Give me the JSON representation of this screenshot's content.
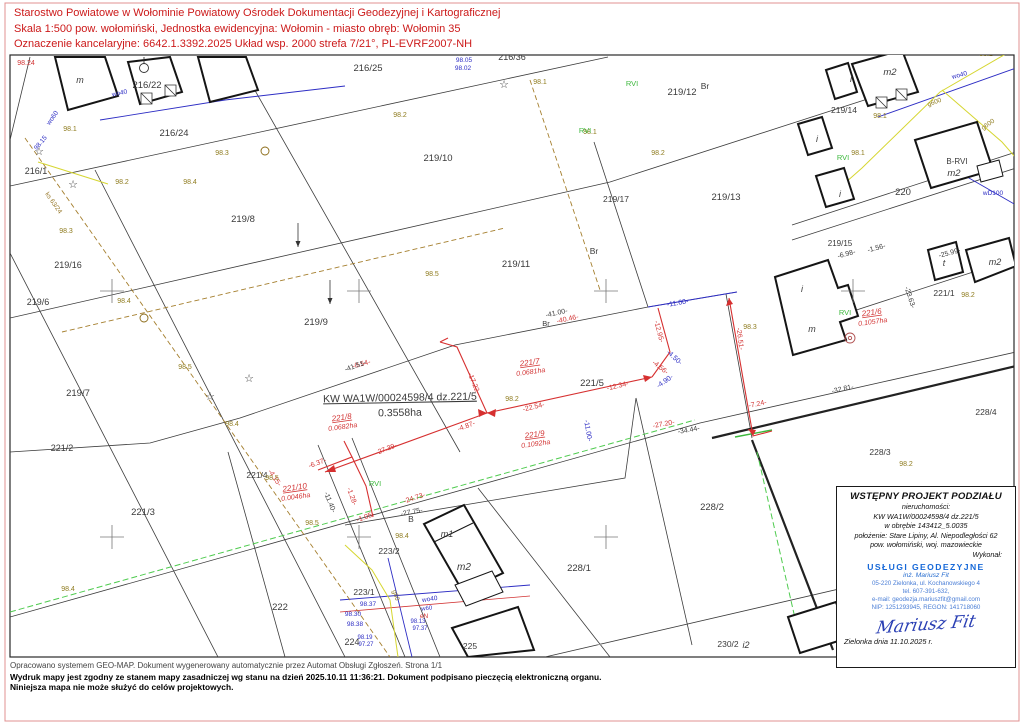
{
  "colors": {
    "k": "#3a3a3a",
    "r": "#d23333",
    "o": "#8f7c1f",
    "b": "#2d2dc4",
    "g": "#3cb83c",
    "n": "#9a7b2e"
  },
  "header": {
    "lines": [
      "Starostwo Powiatowe w Wołominie Powiatowy Ośrodek Dokumentacji Geodezyjnej i Kartograficznej",
      "Skala 1:500  pow. wołomiński, Jednostka ewidencyjna: Wołomin - miasto obręb: Wołomin 35",
      "Oznaczenie kancelaryjne: 6642.1.3392.2025  Układ wsp. 2000 strefa 7/21°, PL-EVRF2007-NH"
    ]
  },
  "footer": {
    "lines": [
      "Opracowano systemem GEO-MAP. Dokument wygenerowany automatycznie przez Automat Obsługi Zgłoszeń. Strona 1/1",
      "Wydruk mapy jest zgodny ze stanem mapy zasadniczej wg stanu na dzień 2025.10.11 11:36:21. Dokument podpisano pieczęcią elektroniczną organu.",
      "Niniejsza mapa nie może służyć do celów projektowych."
    ]
  },
  "info_box": {
    "title": "WSTĘPNY PROJEKT PODZIAŁU",
    "lines": [
      "nieruchomości:",
      "KW WA1W/00024598/4 dz.221/5",
      "w obrębie 143412_5.0035",
      "położenie: Stare Lipiny, Al. Niepodległości 62",
      "pow. wołomiński, woj. mazowieckie",
      "Wykonał:"
    ],
    "company": {
      "name": "USŁUGI GEODEZYJNE",
      "person": "inż. Mariusz Fit",
      "address": "05-220 Zielonka, ul. Kochanowskiego 4",
      "phone": "tel. 607-391-632,",
      "email": "e-mail: geodezja.mariuszfit@gmail.com",
      "ids": "NIP: 1251293945, REGON: 141718060"
    },
    "signature": "Mariusz Fit",
    "date": "Zielonka dnia 11.10.2025 r."
  },
  "map": {
    "labels": [
      [
        "216/22",
        147,
        88,
        "k",
        9.5
      ],
      [
        "216/24",
        174,
        136,
        "k",
        9.5
      ],
      [
        "216/25",
        368,
        71,
        "k",
        9.5
      ],
      [
        "216/36",
        512,
        60,
        "k",
        9
      ],
      [
        "216/1",
        36,
        174,
        "k",
        9
      ],
      [
        "219/8",
        243,
        222,
        "k",
        9.5
      ],
      [
        "219/10",
        438,
        161,
        "k",
        9.5
      ],
      [
        "219/11",
        516,
        267,
        "k",
        9.5
      ],
      [
        "219/12",
        682,
        95,
        "k",
        9.5
      ],
      [
        "219/13",
        726,
        200,
        "k",
        9.5
      ],
      [
        "219/17",
        616,
        202,
        "k",
        8.5
      ],
      [
        "219/16",
        68,
        268,
        "k",
        9
      ],
      [
        "219/6",
        38,
        305,
        "k",
        9
      ],
      [
        "219/7",
        78,
        396,
        "k",
        9.5
      ],
      [
        "219/9",
        316,
        325,
        "k",
        9.5
      ],
      [
        "219/14",
        844,
        113,
        "k",
        8.5
      ],
      [
        "219/15",
        840,
        246,
        "k",
        8
      ],
      [
        "220",
        903,
        195,
        "k",
        9.5
      ],
      [
        "221/1",
        944,
        296,
        "k",
        8.5
      ],
      [
        "221/2",
        62,
        451,
        "k",
        9
      ],
      [
        "221/3",
        143,
        515,
        "k",
        9.5
      ],
      [
        "221/4",
        257,
        478,
        "k",
        8.5
      ],
      [
        "221/5",
        592,
        386,
        "k",
        9.5
      ],
      [
        "222",
        280,
        610,
        "k",
        9.5
      ],
      [
        "223/1",
        364,
        595,
        "k",
        8.5
      ],
      [
        "223/2",
        389,
        554,
        "k",
        8.5
      ],
      [
        "224",
        352,
        645,
        "k",
        9
      ],
      [
        "225",
        470,
        649,
        "k",
        8.5
      ],
      [
        "228/1",
        579,
        571,
        "k",
        9.5
      ],
      [
        "228/2",
        712,
        510,
        "k",
        9.5
      ],
      [
        "228/3",
        880,
        455,
        "k",
        8.5
      ],
      [
        "228/4",
        986,
        415,
        "k",
        8.5
      ],
      [
        "230/2",
        728,
        647,
        "k",
        8.5
      ],
      [
        "Br",
        705,
        89,
        "k",
        8.5
      ],
      [
        "Br",
        594,
        254,
        "k",
        8.5
      ],
      [
        "Br",
        546,
        326,
        "k",
        7.5
      ],
      [
        "B",
        411,
        522,
        "k",
        8.5
      ],
      [
        "m",
        80,
        83,
        "k",
        9,
        0,
        "i"
      ],
      [
        "m",
        812,
        332,
        "k",
        9,
        0,
        "i"
      ],
      [
        "m2",
        890,
        75,
        "k",
        9.5,
        0,
        "i"
      ],
      [
        "m1",
        447,
        537,
        "k",
        9,
        0,
        "i"
      ],
      [
        "m2",
        464,
        570,
        "k",
        10,
        0,
        "i"
      ],
      [
        "t",
        944,
        266,
        "k",
        9,
        0,
        "i"
      ],
      [
        "i",
        851,
        82,
        "k",
        9,
        0,
        "i"
      ],
      [
        "i",
        817,
        142,
        "k",
        9,
        0,
        "i"
      ],
      [
        "i",
        840,
        197,
        "k",
        9,
        0,
        "i"
      ],
      [
        "i",
        802,
        292,
        "k",
        9,
        0,
        "i"
      ],
      [
        "i2",
        746,
        648,
        "k",
        9,
        0,
        "i"
      ],
      [
        "m2",
        995,
        265,
        "k",
        9,
        0,
        "i"
      ],
      [
        "B-RVI",
        957,
        164,
        "k",
        8
      ],
      [
        "m2",
        954,
        176,
        "k",
        9.5,
        0,
        "i"
      ],
      [
        "KW WA1W/00024598/4 dz.221/5",
        400,
        401,
        "k",
        10.5,
        -1,
        "u"
      ],
      [
        "0.3558ha",
        400,
        416,
        "k",
        10.5,
        -1
      ],
      [
        "221/7",
        530,
        365,
        "r",
        8,
        -8,
        "iu"
      ],
      [
        "0.0681ha",
        531,
        374,
        "r",
        7,
        -8,
        "i"
      ],
      [
        "221/8",
        342,
        420,
        "r",
        8,
        -8,
        "iu"
      ],
      [
        "0.0682ha",
        343,
        429,
        "r",
        7,
        -8,
        "i"
      ],
      [
        "221/9",
        535,
        437,
        "r",
        8,
        -8,
        "iu"
      ],
      [
        "0.1092ha",
        536,
        446,
        "r",
        7,
        -8,
        "i"
      ],
      [
        "221/6",
        872,
        315,
        "r",
        8,
        -8,
        "iu"
      ],
      [
        "0.1057ha",
        873,
        324,
        "r",
        7,
        -8,
        "i"
      ],
      [
        "221/10",
        295,
        490,
        "r",
        8,
        -8,
        "iu"
      ],
      [
        "0.0046ha",
        296,
        499,
        "r",
        7,
        -8,
        "i"
      ],
      [
        "-0.54-",
        362,
        366,
        "r",
        7,
        -15
      ],
      [
        "-17.22-",
        472,
        384,
        "r",
        7,
        68
      ],
      [
        "-27.39-",
        387,
        451,
        "r",
        7,
        -21
      ],
      [
        "-4.87-",
        467,
        428,
        "r",
        7,
        -21
      ],
      [
        "-22.54-",
        534,
        409,
        "r",
        7,
        -13
      ],
      [
        "-12.34-",
        618,
        388,
        "r",
        7,
        -13
      ],
      [
        "-4.56-",
        659,
        369,
        "r",
        7,
        38
      ],
      [
        "-12.95-",
        657,
        332,
        "r",
        7,
        75
      ],
      [
        "-26.51-",
        738,
        339,
        "r",
        7,
        83
      ],
      [
        "-7.24-",
        758,
        406,
        "r",
        7,
        -12
      ],
      [
        "-27.20-",
        664,
        426,
        "r",
        7,
        -11
      ],
      [
        "-24.73-",
        415,
        500,
        "r",
        7,
        -18
      ],
      [
        "-40.46-",
        568,
        321,
        "r",
        7,
        -12
      ],
      [
        "-6.37-",
        318,
        465,
        "r",
        7,
        -20
      ],
      [
        "-4.15-",
        273,
        479,
        "r",
        7,
        55
      ],
      [
        "-1.28-",
        350,
        497,
        "r",
        7,
        70
      ],
      [
        "-1.05-",
        366,
        519,
        "r",
        7,
        -20
      ],
      [
        "-41.51-",
        356,
        368,
        "k",
        7,
        -20
      ],
      [
        "-41.00-",
        557,
        315,
        "k",
        7,
        -12
      ],
      [
        "-25.99-",
        950,
        255,
        "k",
        7,
        -15
      ],
      [
        "-32.81-",
        843,
        391,
        "k",
        7,
        -12
      ],
      [
        "-6.98-",
        847,
        256,
        "k",
        7,
        -15
      ],
      [
        "-1.56-",
        877,
        250,
        "k",
        7,
        -15
      ],
      [
        "-23.63-",
        908,
        298,
        "k",
        7,
        72
      ],
      [
        "-27.75-",
        412,
        514,
        "k",
        7,
        -11
      ],
      [
        "-34.44-",
        689,
        432,
        "k",
        7,
        -10
      ],
      [
        "-11.40-",
        328,
        503,
        "k",
        7,
        68
      ],
      [
        "-11.00-",
        678,
        305,
        "b",
        7,
        -10
      ],
      [
        "-4.50-",
        673,
        359,
        "b",
        7,
        42
      ],
      [
        "-4.90-",
        666,
        383,
        "b",
        7,
        -35
      ],
      [
        "-11.00-",
        586,
        431,
        "b",
        7,
        80
      ],
      [
        "98.1",
        70,
        131,
        "o",
        7
      ],
      [
        "98.2",
        122,
        184,
        "o",
        7
      ],
      [
        "98.3",
        66,
        233,
        "o",
        7
      ],
      [
        "98.4",
        124,
        303,
        "o",
        7
      ],
      [
        "98.4",
        190,
        184,
        "o",
        7
      ],
      [
        "98.3",
        222,
        155,
        "o",
        7
      ],
      [
        "98.2",
        400,
        117,
        "o",
        7
      ],
      [
        "98.5",
        432,
        276,
        "o",
        7
      ],
      [
        "98.5",
        185,
        369,
        "o",
        7
      ],
      [
        "98.2",
        658,
        155,
        "o",
        7
      ],
      [
        "98.5",
        272,
        480,
        "o",
        7
      ],
      [
        "98.5",
        312,
        525,
        "o",
        7
      ],
      [
        "98.4",
        402,
        538,
        "o",
        7
      ],
      [
        "98.4",
        232,
        426,
        "o",
        7
      ],
      [
        "98.4",
        68,
        591,
        "o",
        7
      ],
      [
        "98.2",
        512,
        401,
        "o",
        7
      ],
      [
        "98.3",
        750,
        329,
        "o",
        7
      ],
      [
        "98.2",
        968,
        297,
        "o",
        7
      ],
      [
        "98.1",
        880,
        118,
        "o",
        7
      ],
      [
        "98.1",
        858,
        155,
        "o",
        7
      ],
      [
        "98.2",
        986,
        56,
        "o",
        7
      ],
      [
        "98.1",
        540,
        84,
        "o",
        7
      ],
      [
        "98.1",
        590,
        134,
        "o",
        7
      ],
      [
        "98.2",
        906,
        466,
        "o",
        7
      ],
      [
        "98.24",
        26,
        65,
        "r",
        7
      ],
      [
        "98.05",
        464,
        62,
        "b",
        6.5
      ],
      [
        "98.02",
        463,
        70,
        "b",
        6.5
      ],
      [
        "98.37",
        368,
        606,
        "b",
        6.5
      ],
      [
        "98.30",
        353,
        616,
        "b",
        6.5
      ],
      [
        "98.38",
        355,
        626,
        "b",
        6.5
      ],
      [
        "98.19",
        365,
        639,
        "b",
        6
      ],
      [
        "97.27",
        366,
        646,
        "b",
        6
      ],
      [
        "98.13",
        418,
        623,
        "b",
        6
      ],
      [
        "97.37",
        420,
        630,
        "b",
        6
      ],
      [
        "98.15",
        42,
        144,
        "b",
        6.5,
        -50
      ],
      [
        "wo40",
        120,
        95,
        "b",
        6.5,
        -12
      ],
      [
        "wo40",
        960,
        77,
        "b",
        6.5,
        -15
      ],
      [
        "wo40",
        430,
        601,
        "b",
        6.5,
        -8
      ],
      [
        "wD100",
        993,
        195,
        "b",
        6.5
      ],
      [
        "wo60",
        54,
        119,
        "b",
        6.5,
        -55
      ],
      [
        "w60",
        427,
        610,
        "b",
        6,
        -8
      ],
      [
        "g600",
        935,
        104,
        "o",
        6.5,
        -20
      ],
      [
        "g600",
        989,
        126,
        "o",
        6.5,
        -35
      ],
      [
        "g60",
        394,
        596,
        "o",
        6.5,
        70
      ],
      [
        "eN",
        424,
        618,
        "r",
        6.5
      ],
      [
        "ks 63/24",
        52,
        204,
        "n",
        6.5,
        55
      ],
      [
        "RVI",
        632,
        86,
        "g",
        7.5
      ],
      [
        "RVI",
        585,
        133,
        "g",
        7.5
      ],
      [
        "RVI",
        843,
        160,
        "g",
        7.5
      ],
      [
        "RVI",
        845,
        315,
        "g",
        7.5
      ],
      [
        "RVI",
        375,
        486,
        "g",
        7.5
      ]
    ],
    "symbols": {
      "crosses": [
        [
          112,
          291
        ],
        [
          359,
          291
        ],
        [
          606,
          291
        ],
        [
          853,
          291
        ],
        [
          112,
          537
        ],
        [
          359,
          537
        ],
        [
          606,
          537
        ]
      ],
      "stars": [
        [
          39,
          152
        ],
        [
          73,
          185
        ],
        [
          504,
          85
        ],
        [
          249,
          379
        ],
        [
          210,
          397
        ]
      ],
      "circles": [
        [
          265,
          151
        ],
        [
          144,
          318
        ]
      ],
      "wells": [
        [
          850,
          338
        ]
      ],
      "pmarks": [
        [
          144,
          68
        ]
      ],
      "arrows": [
        [
          298,
          235
        ],
        [
          330,
          292
        ]
      ]
    }
  }
}
